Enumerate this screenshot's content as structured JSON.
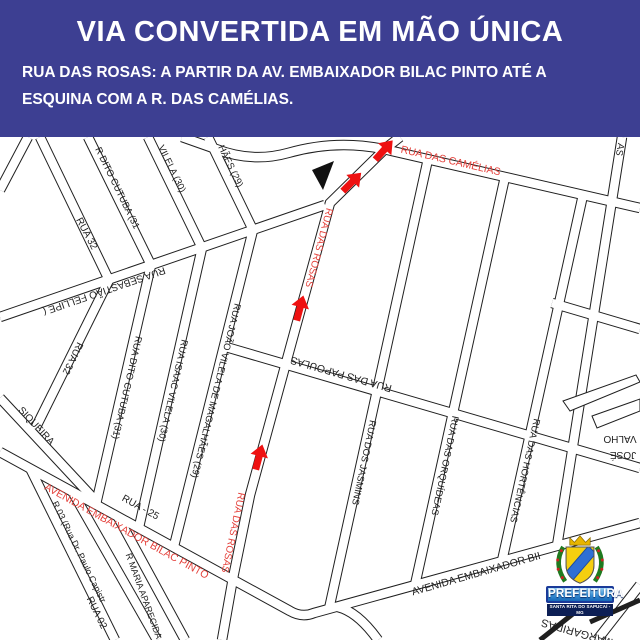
{
  "header": {
    "title": "VIA CONVERTIDA EM MÃO ÚNICA",
    "subtitle": "RUA DAS ROSAS: A PARTIR DA AV. EMBAIXADOR BILAC PINTO ATÉ A ESQUINA COM A R. DAS CAMÉLIAS.",
    "bg_color": "#3d3f92",
    "text_color": "#ffffff"
  },
  "map": {
    "bg_color": "#ffffff",
    "road_outline_color": "#1f1f1f",
    "road_fill_color": "#ffffff",
    "label_color": "#1f1f1f",
    "highlight_color": "#e4403a",
    "arrow_color": "#ee1111",
    "arrows_count": 4,
    "streets": [
      {
        "id": "rua32top",
        "label": "RUA  32",
        "highlighted": false
      },
      {
        "id": "cutubatop",
        "label": "R DITO CUTUBA (31",
        "highlighted": false
      },
      {
        "id": "vilelatop",
        "label": "VILELA (30)",
        "highlighted": false
      },
      {
        "id": "magalhaestop",
        "label": "HÃES (29)",
        "highlighted": false
      },
      {
        "id": "cornerstub",
        "label": "",
        "highlighted": false
      },
      {
        "id": "sebastiao",
        "label": "RUA SEBASTIÃO FELLIPE (",
        "highlighted": false
      },
      {
        "id": "rua32",
        "label": "RUA 32",
        "highlighted": false
      },
      {
        "id": "siqueira",
        "label": "SIQUEIRA",
        "highlighted": false
      },
      {
        "id": "cutuba",
        "label": "RUA DITO CUTUBA (31)",
        "highlighted": false
      },
      {
        "id": "isaacvilela",
        "label": "RUA ISAAC VILELA (30)",
        "highlighted": false
      },
      {
        "id": "joaovilela",
        "label": "RUA JOÃO VILELA DE MAGALHÃES (29)",
        "highlighted": false
      },
      {
        "id": "rosas",
        "label": "RUA DAS ROSAS",
        "highlighted": true
      },
      {
        "id": "camelias",
        "label": "RUA DAS CAMÉLIAS",
        "highlighted": true
      },
      {
        "id": "papoulas",
        "label": "RUA DAS PAPOULAS",
        "highlighted": false
      },
      {
        "id": "jasmins",
        "label": "RUA DOS JASMINS",
        "highlighted": false
      },
      {
        "id": "orquideas",
        "label": "RUA DAS ORQUÍDEAS",
        "highlighted": false
      },
      {
        "id": "hortencias",
        "label": "RUA DAS HORTÊNCIAS",
        "highlighted": false
      },
      {
        "id": "rightedge",
        "label": "AS",
        "highlighted": false
      },
      {
        "id": "crossright",
        "label": "",
        "highlighted": false
      },
      {
        "id": "avenuered",
        "label": "AVENIDA EMBAIXADOR BILAC PINTO",
        "highlighted": true
      },
      {
        "id": "avenueblack",
        "label": "AVENIDA  EMBAIXADOR BII",
        "highlighted": false
      },
      {
        "id": "rua25",
        "label": "RUA - 25",
        "highlighted": false
      },
      {
        "id": "r03",
        "label": "R 03 (Rua Dr. Paulo Capistr",
        "highlighted": false
      },
      {
        "id": "rua02",
        "label": "RUA 02",
        "highlighted": false
      },
      {
        "id": "mariaaparecida",
        "label": "R MARIA APARECIDA",
        "highlighted": false
      },
      {
        "id": "curvebottom",
        "label": "",
        "highlighted": false
      },
      {
        "id": "rightbottom",
        "label": "",
        "highlighted": false
      },
      {
        "id": "margaridas",
        "label": "MARGARIDAS",
        "highlighted": false
      },
      {
        "id": "valho",
        "label": "VALHO",
        "highlighted": false
      },
      {
        "id": "jose",
        "label": "JOSÉ",
        "highlighted": false
      }
    ]
  },
  "logo": {
    "org": "PREFEITURA",
    "city": "SANTA RITA DO SAPUCAÍ - MG",
    "banner_color": "#1668b8",
    "banner_border": "#1a3a99",
    "shield_color": "#f5cf0f",
    "band_color": "#2f6fd4",
    "garland_color": "#1f7a1f",
    "crown_color": "#e8b500"
  }
}
